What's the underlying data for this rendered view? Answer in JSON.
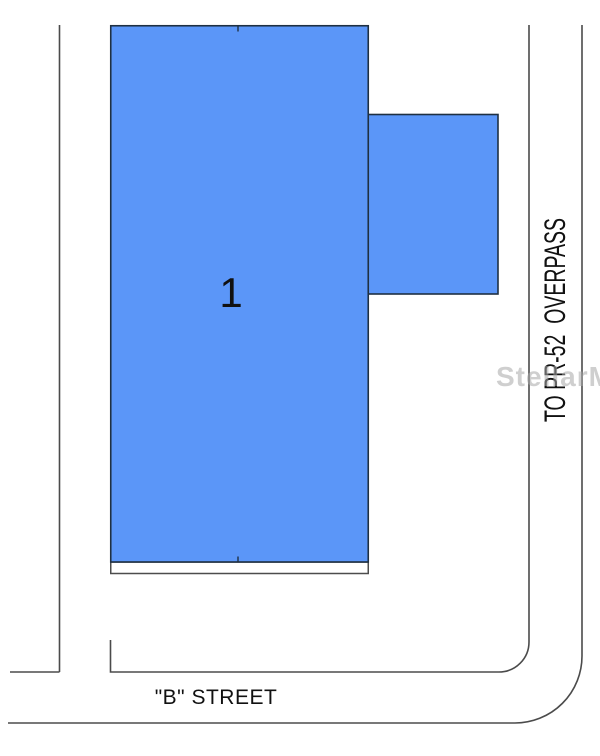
{
  "plat": {
    "lot_label": "1",
    "street_label": "\"B\" STREET",
    "side_road_label": "TO PR-52  OVERPASS",
    "watermark": "StellarMLS",
    "colors": {
      "lot_fill": "#5b96f8",
      "lot_border": "#1f3042",
      "street_line": "#4b4b4b",
      "strip_border": "#4d4d4d",
      "text": "#111111",
      "watermark": "#a9a9a9"
    }
  }
}
